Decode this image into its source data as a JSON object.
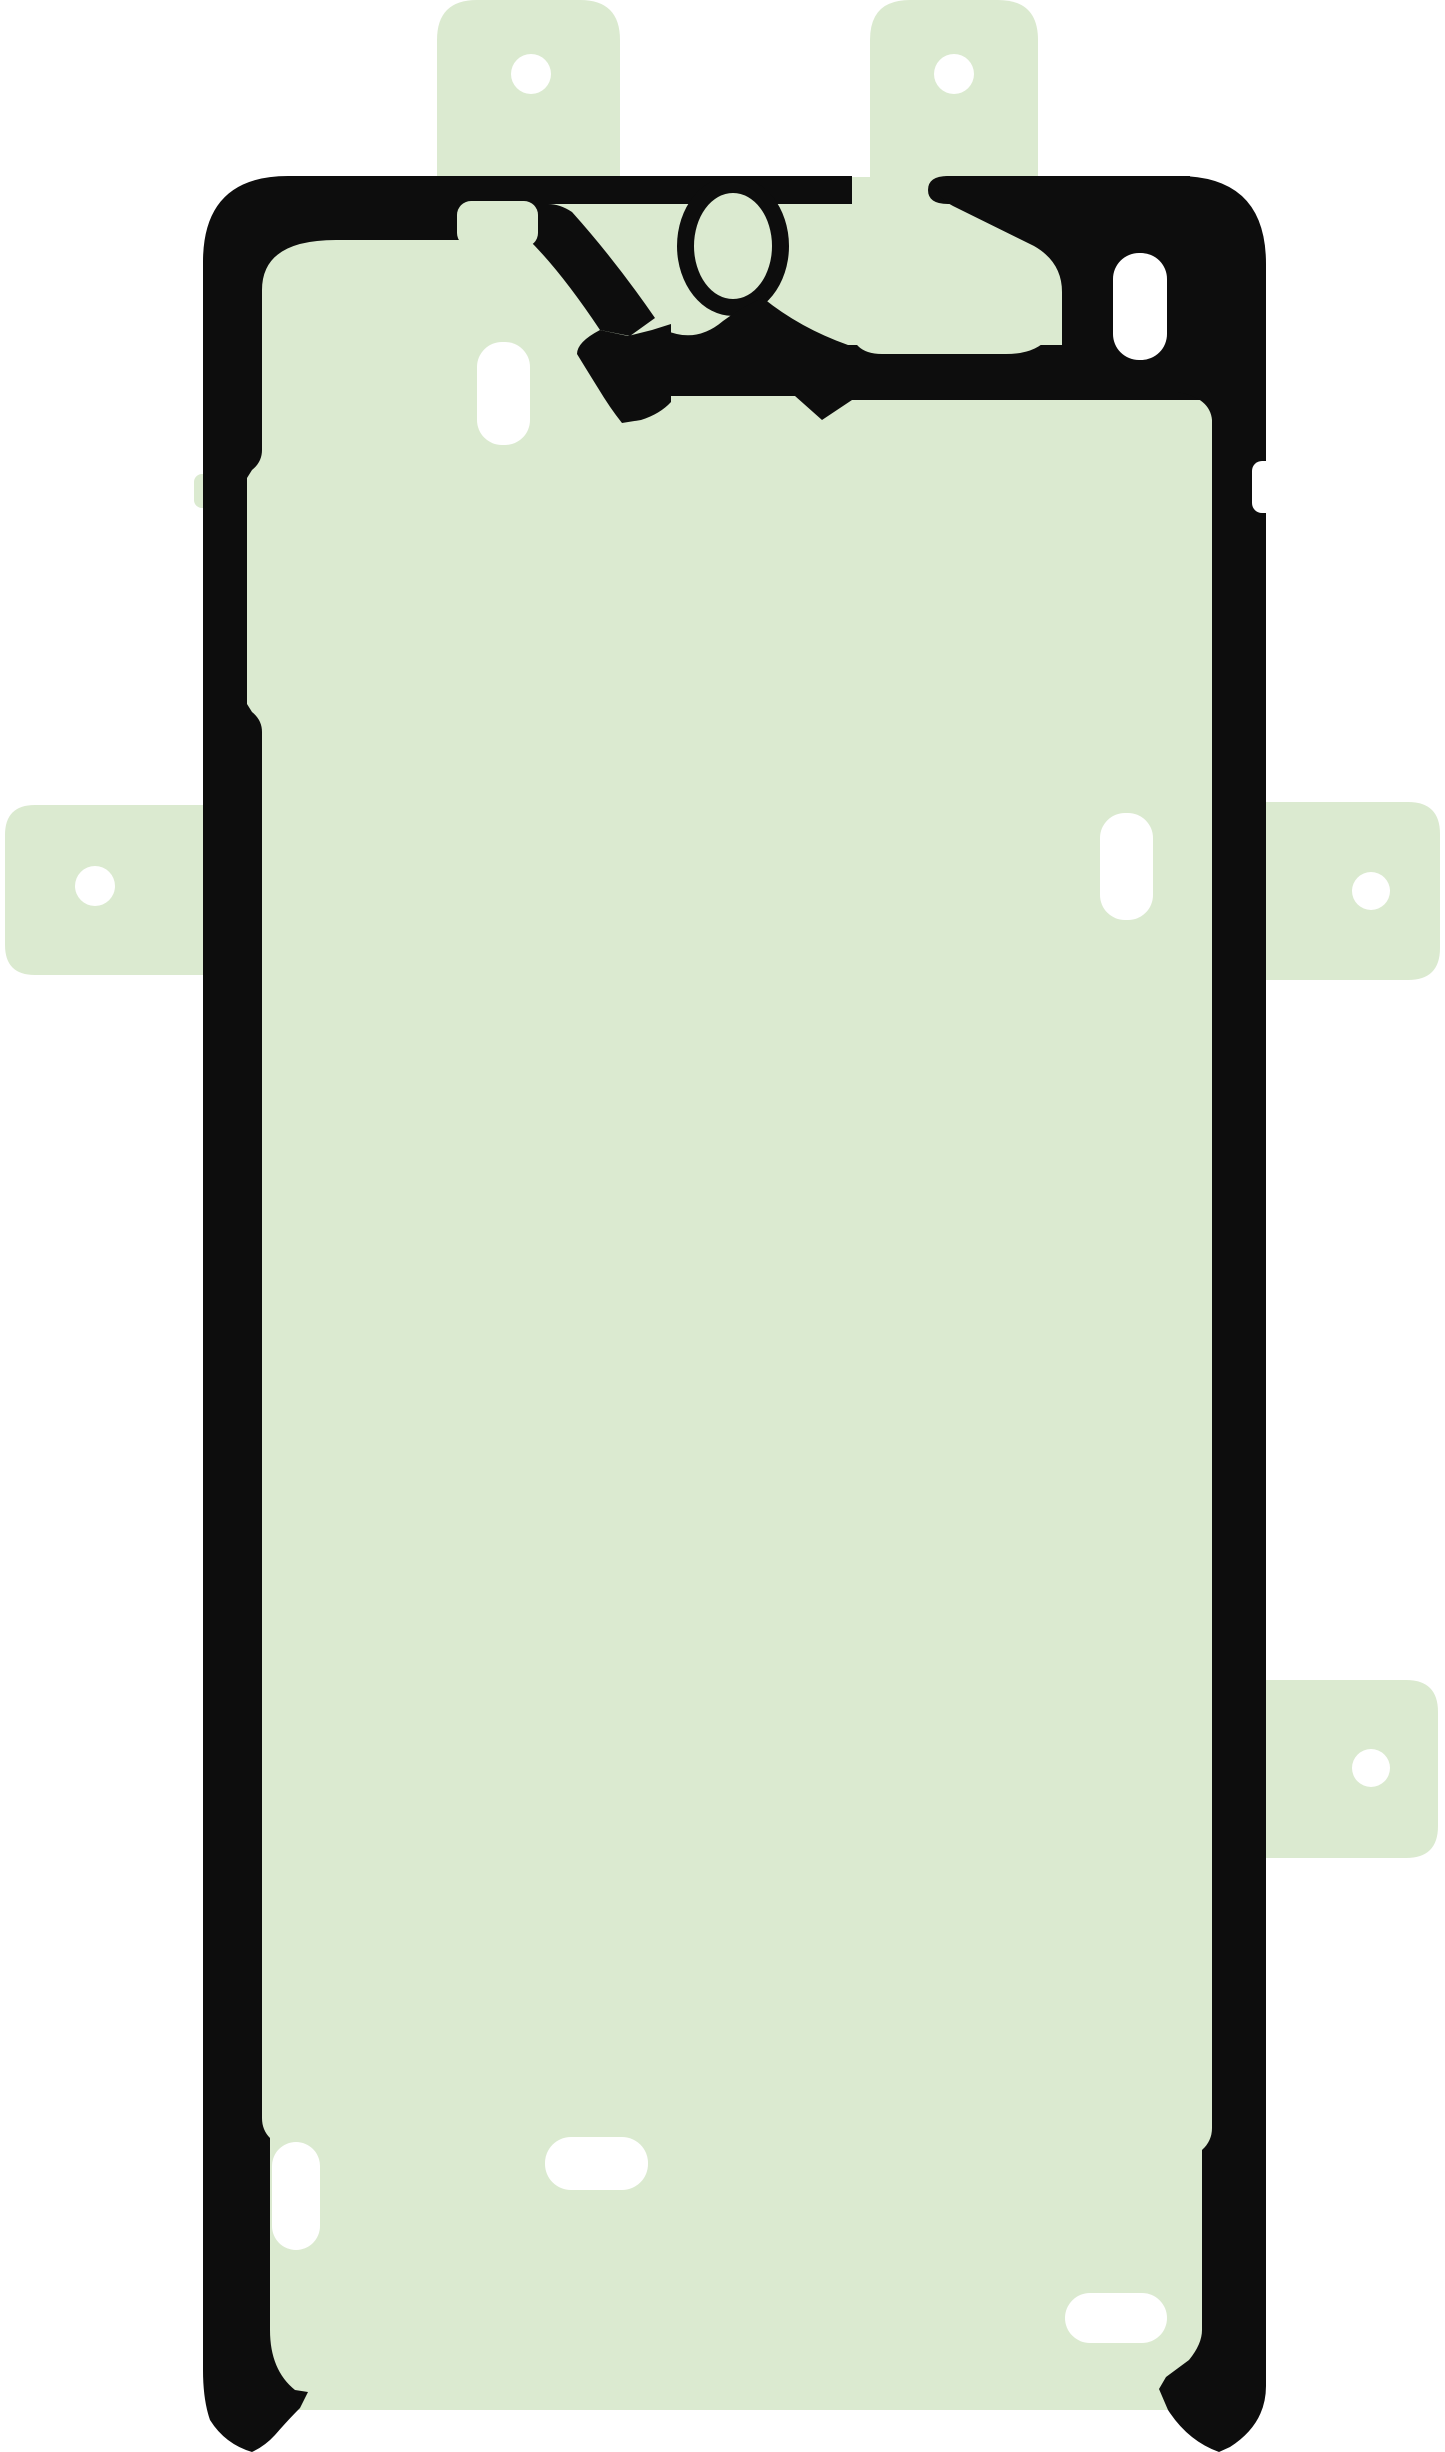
{
  "image": {
    "kind": "product-photo",
    "subject": "Die-cut smartphone display adhesive sticker (screen gasket tape) with liner pull-tabs",
    "orientation": "portrait",
    "visible_text": "",
    "background": "plain white"
  },
  "colors": {
    "background": "#ffffff",
    "sheet_green": "#dbead0",
    "outline_black": "#0d0d0d",
    "hole_white": "#ffffff"
  },
  "parts": {
    "sheet": "pale green adhesive sheet, rounded phone-shaped outline",
    "frame": "black printed gasket outline around perimeter",
    "top_cutout": "complex earpiece/camera die-cut pattern at top edge",
    "camera_ring": "oval camera cutout ring near top center",
    "tabs": [
      {
        "name": "top-left pull tab",
        "hole": "round"
      },
      {
        "name": "top-right pull tab",
        "hole": "round"
      },
      {
        "name": "left side pull tab",
        "hole": "round"
      },
      {
        "name": "right side pull tab",
        "hole": "round"
      },
      {
        "name": "right lower pull tab",
        "hole": "round"
      }
    ],
    "slots": [
      "vertical slot below top pattern (left)",
      "vertical slot inside right hook",
      "vertical slot right side upper area",
      "vertical slot bottom left",
      "horizontal slot bottom center",
      "horizontal slot bottom right"
    ],
    "feet": "black outline feet at both bottom corners extending below green edge"
  }
}
